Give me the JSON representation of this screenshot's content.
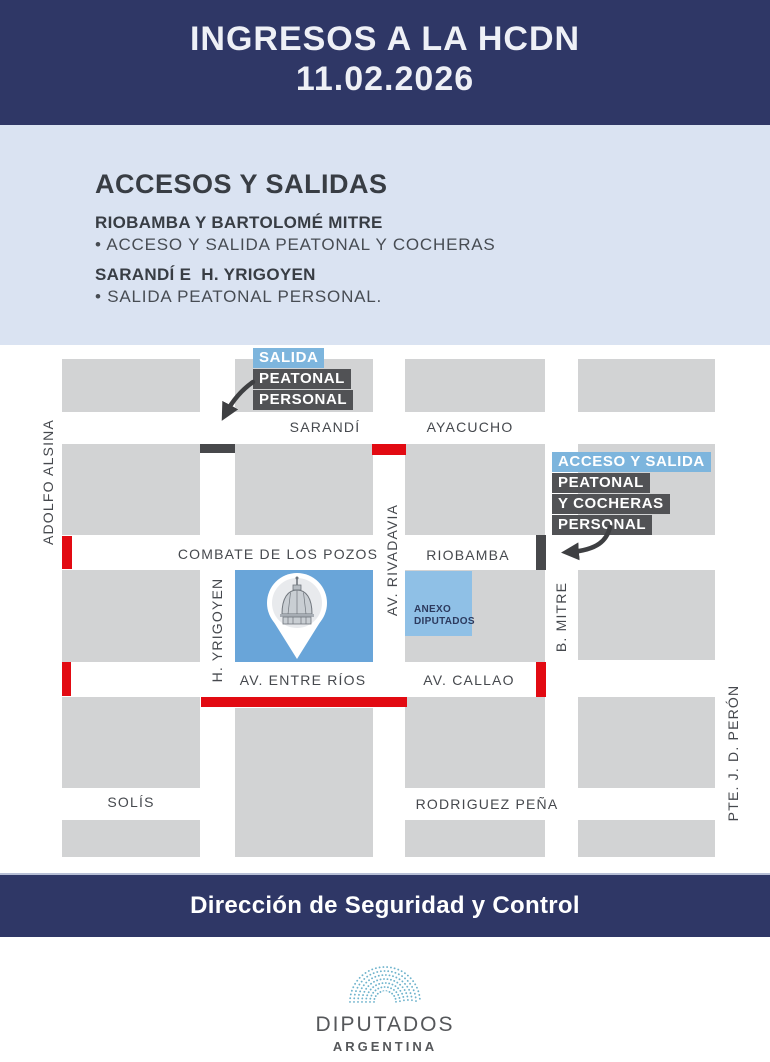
{
  "header": {
    "title": "INGRESOS A LA HCDN",
    "date": "11.02.2026"
  },
  "accesses": {
    "title": "ACCESOS Y SALIDAS",
    "entries": [
      {
        "heading": "RIOBAMBA Y BARTOLOMÉ MITRE",
        "detail": "• ACCESO Y SALIDA PEATONAL Y COCHERAS"
      },
      {
        "heading": "SARANDÍ E  H. YRIGOYEN",
        "detail": "• SALIDA PEATONAL PERSONAL."
      }
    ]
  },
  "map": {
    "streets": {
      "sarandi": "SARANDÍ",
      "ayacucho": "AYACUCHO",
      "combate_de_los_pozos": "COMBATE DE LOS POZOS",
      "riobamba": "RIOBAMBA",
      "av_entre_rios": "AV. ENTRE RÍOS",
      "av_callao": "AV. CALLAO",
      "solis": "SOLÍS",
      "rodriguez_pena": "RODRIGUEZ PEÑA",
      "adolfo_alsina": "ADOLFO ALSINA",
      "h_yrigoyen": "H. YRIGOYEN",
      "av_rivadavia": "AV. RIVADAVIA",
      "b_mitre": "B. MITRE",
      "pte_jd_peron": "PTE. J. D. PERÓN"
    },
    "callouts": {
      "salida": {
        "lines": [
          "SALIDA",
          "PEATONAL",
          "PERSONAL"
        ]
      },
      "acceso": {
        "lines": [
          "ACCESO Y SALIDA",
          "PEATONAL",
          "Y COCHERAS",
          "PERSONAL"
        ]
      }
    },
    "anexo": {
      "lines": [
        "ANEXO",
        "DIPUTADOS"
      ]
    }
  },
  "footer": {
    "band": "Dirección de Seguridad y Control"
  },
  "logo": {
    "title": "DIPUTADOS",
    "subtitle": "ARGENTINA"
  },
  "colors": {
    "navy": "#2f3766",
    "panel_blue": "#dae3f2",
    "block_gray": "#d2d3d4",
    "closed_red": "#e20a12",
    "marker_dark": "#47484b",
    "callout_blue": "#7db5dd",
    "callout_dark": "#515255",
    "congress_blue": "#69a5d9",
    "anexo_blue": "#8fc0e6",
    "logo_dots": "#6fb3cc"
  }
}
